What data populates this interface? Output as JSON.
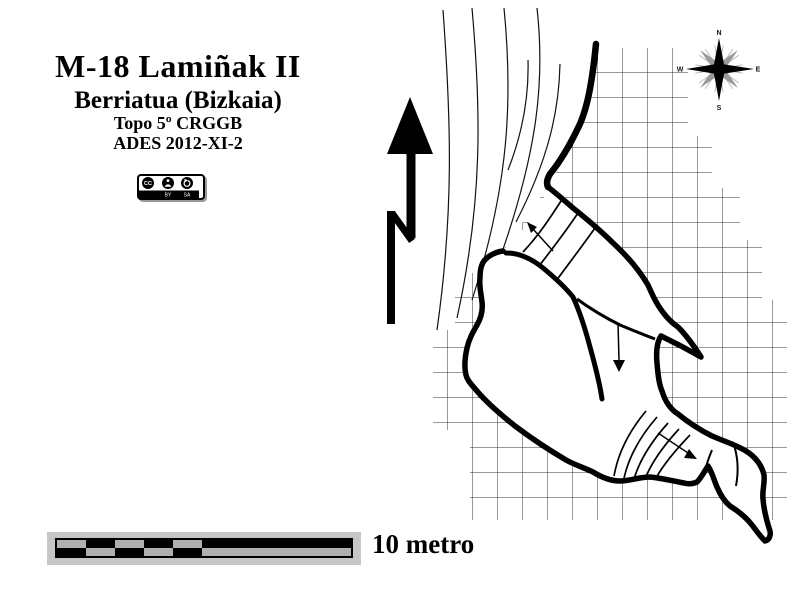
{
  "header": {
    "title": "M-18 Lamiñak II",
    "subtitle": "Berriatua (Bizkaia)",
    "topo_line": "Topo 5º CRGGB",
    "credit_line": "ADES 2012-XI-2"
  },
  "license": {
    "cc": "CC",
    "by": "BY",
    "sa": "SA"
  },
  "scale": {
    "label": "10 metro",
    "divisions": 5
  },
  "compass": {
    "north": "N",
    "south": "S",
    "east": "E",
    "west": "W"
  },
  "map": {
    "kind": "cave survey plan",
    "features": [
      "north-arrow",
      "compass-rose",
      "contour-lines",
      "survey-grid",
      "cave-passage-outline",
      "cross-section-lines",
      "flow-arrows",
      "scale-bar"
    ],
    "colors": {
      "ink": "#000000",
      "grid_line": "#333333",
      "bar_gray": "#b0b0b0",
      "bar_backdrop": "#c6c6c6",
      "compass_gray": "#9a9a9a"
    }
  }
}
